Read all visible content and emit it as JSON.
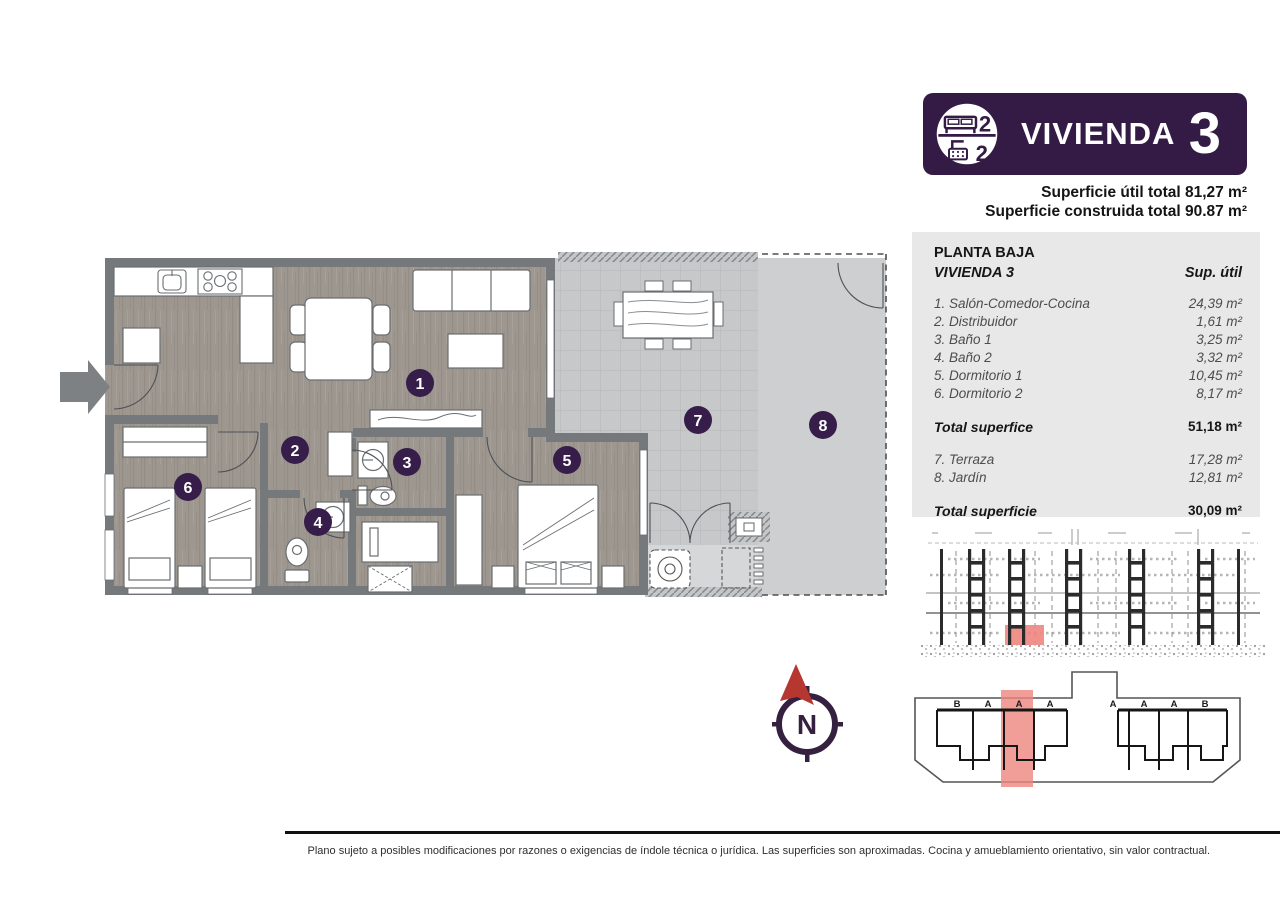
{
  "header": {
    "title": "VIVIENDA",
    "unit_number": "3",
    "bedrooms_count": "2",
    "bathrooms_count": "2",
    "superficie_util": "Superficie útil total 81,27 m²",
    "superficie_construida": "Superficie construida total 90.87 m²"
  },
  "area_table": {
    "floor_label": "PLANTA BAJA",
    "unit_label": "VIVIENDA 3",
    "column_header": "Sup. útil",
    "rooms": [
      {
        "label": "1. Salón-Comedor-Cocina",
        "value": "24,39 m²"
      },
      {
        "label": "2. Distribuidor",
        "value": "1,61 m²"
      },
      {
        "label": "3. Baño 1",
        "value": "3,25 m²"
      },
      {
        "label": "4. Baño 2",
        "value": "3,32 m²"
      },
      {
        "label": "5. Dormitorio 1",
        "value": "10,45 m²"
      },
      {
        "label": "6. Dormitorio 2",
        "value": "8,17 m²"
      }
    ],
    "total_interior_label": "Total superfice",
    "total_interior_value": "51,18 m²",
    "exterior_rooms": [
      {
        "label": "7. Terraza",
        "value": "17,28 m²"
      },
      {
        "label": "8. Jardín",
        "value": "12,81 m²"
      }
    ],
    "total_exterior_label": "Total superficie",
    "total_exterior_value": "30,09 m²"
  },
  "floorplan": {
    "badges": [
      "1",
      "2",
      "3",
      "4",
      "5",
      "6",
      "7",
      "8"
    ]
  },
  "compass": {
    "north_label": "N"
  },
  "building_plan": {
    "unit_letters": [
      "B",
      "A",
      "A",
      "A",
      "A",
      "A",
      "A",
      "B"
    ]
  },
  "footer": {
    "disclaimer": "Plano sujeto a posibles modificaciones por razones o exigencias de índole técnica o jurídica. Las superficies son aproximadas. Cocina y amueblamiento orientativo, sin valor contractual."
  },
  "colors": {
    "brand_purple": "#341b45",
    "highlight_pink": "#ee867e",
    "compass_red": "#b5372f"
  }
}
